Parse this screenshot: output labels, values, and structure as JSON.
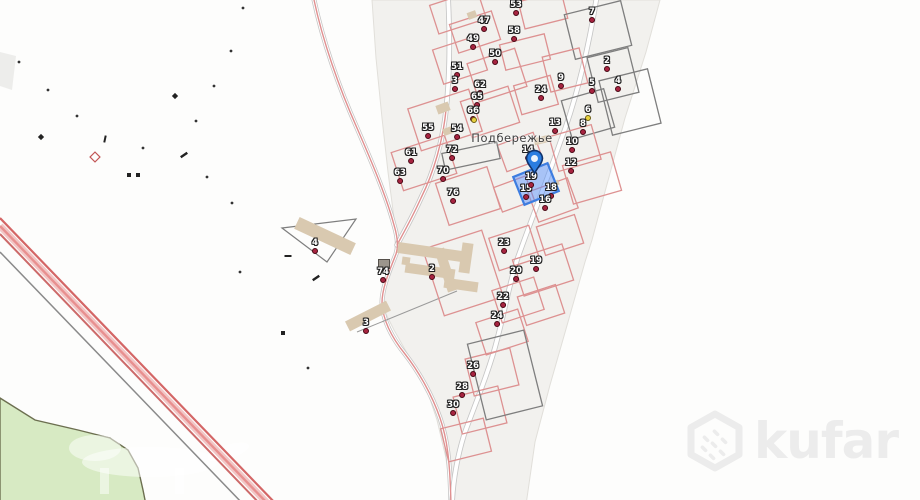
{
  "map": {
    "place_label": "Подбережье",
    "watermark_text": "kufar",
    "colors": {
      "background": "#fdfdfc",
      "residential_fill": "#f2f1ee",
      "residential_edge": "#e1dfda",
      "green_area": "#d7eac3",
      "green_edge": "#6c6f50",
      "road_casing": "#c6c6c6",
      "road_fill": "#ffffff",
      "route_pink": "#e09090",
      "railway_red": "#cc4b4b",
      "railway_light": "#f2c6c6",
      "parcel_red": "#dd9191",
      "parcel_dark": "#7e7e7e",
      "building_fill": "#d9c9b0",
      "marker_dot": "#a72440",
      "marker_yellow": "#e8d23f",
      "selected_fill": "rgba(77,140,255,0.45)",
      "selected_stroke": "#3d7de0",
      "pin_blue": "#2a7de1",
      "watermark_gray": "#ececec"
    },
    "selected_marker": {
      "n": "19",
      "x": 531,
      "y": 177
    },
    "pin": {
      "x": 534,
      "y": 174
    },
    "selected_parcel": {
      "x": 536,
      "y": 184,
      "w": 37,
      "h": 30,
      "r": -22
    },
    "markers": [
      {
        "n": "53",
        "x": 516,
        "y": 5
      },
      {
        "n": "7",
        "x": 592,
        "y": 12
      },
      {
        "n": "47",
        "x": 484,
        "y": 21
      },
      {
        "n": "58",
        "x": 514,
        "y": 31
      },
      {
        "n": "49",
        "x": 473,
        "y": 39
      },
      {
        "n": "50",
        "x": 495,
        "y": 54
      },
      {
        "n": "2",
        "x": 607,
        "y": 61
      },
      {
        "n": "51",
        "x": 457,
        "y": 67
      },
      {
        "n": "9",
        "x": 561,
        "y": 78
      },
      {
        "n": "3",
        "x": 455,
        "y": 81
      },
      {
        "n": "4",
        "x": 618,
        "y": 81
      },
      {
        "n": "5",
        "x": 592,
        "y": 83
      },
      {
        "n": "62",
        "x": 480,
        "y": 85
      },
      {
        "n": "24",
        "x": 541,
        "y": 90
      },
      {
        "n": "65",
        "x": 477,
        "y": 97
      },
      {
        "n": "6",
        "x": 588,
        "y": 110,
        "dot": "yellow"
      },
      {
        "n": "66",
        "x": 473,
        "y": 111
      },
      {
        "n": "13",
        "x": 555,
        "y": 123
      },
      {
        "n": "8",
        "x": 583,
        "y": 124
      },
      {
        "n": "55",
        "x": 428,
        "y": 128
      },
      {
        "n": "54",
        "x": 457,
        "y": 129
      },
      {
        "n": "10",
        "x": 572,
        "y": 142
      },
      {
        "n": "72",
        "x": 452,
        "y": 150
      },
      {
        "n": "14",
        "x": 528,
        "y": 150
      },
      {
        "n": "61",
        "x": 411,
        "y": 153
      },
      {
        "n": "12",
        "x": 571,
        "y": 163
      },
      {
        "n": "70",
        "x": 443,
        "y": 171
      },
      {
        "n": "63",
        "x": 400,
        "y": 173
      },
      {
        "n": "15",
        "x": 526,
        "y": 189
      },
      {
        "n": "18",
        "x": 551,
        "y": 188
      },
      {
        "n": "76",
        "x": 453,
        "y": 193
      },
      {
        "n": "16",
        "x": 545,
        "y": 200
      },
      {
        "n": "4",
        "x": 315,
        "y": 243
      },
      {
        "n": "23",
        "x": 504,
        "y": 243
      },
      {
        "n": "19",
        "x": 536,
        "y": 261
      },
      {
        "n": "2",
        "x": 432,
        "y": 269
      },
      {
        "n": "20",
        "x": 516,
        "y": 271
      },
      {
        "n": "74",
        "x": 383,
        "y": 272
      },
      {
        "n": "22",
        "x": 503,
        "y": 297
      },
      {
        "n": "24",
        "x": 497,
        "y": 316
      },
      {
        "n": "3",
        "x": 366,
        "y": 323
      },
      {
        "n": "26",
        "x": 473,
        "y": 366
      },
      {
        "n": "28",
        "x": 462,
        "y": 387
      },
      {
        "n": "30",
        "x": 453,
        "y": 405
      }
    ],
    "extra_dots": [
      {
        "x": 474,
        "y": 119,
        "dot": "yellow"
      }
    ],
    "parcels": [
      [
        458,
        12,
        50,
        30,
        -18,
        "red"
      ],
      [
        475,
        32,
        44,
        30,
        -18,
        "red"
      ],
      [
        543,
        10,
        44,
        28,
        -14,
        "red"
      ],
      [
        598,
        30,
        58,
        46,
        -14,
        "dark"
      ],
      [
        525,
        52,
        46,
        26,
        -14,
        "red"
      ],
      [
        460,
        60,
        46,
        36,
        -18,
        "red"
      ],
      [
        497,
        75,
        50,
        40,
        -18,
        "red"
      ],
      [
        565,
        70,
        38,
        36,
        -14,
        "red"
      ],
      [
        613,
        75,
        42,
        46,
        -14,
        "dark"
      ],
      [
        445,
        120,
        64,
        44,
        -18,
        "red"
      ],
      [
        490,
        112,
        50,
        38,
        -18,
        "red"
      ],
      [
        588,
        114,
        44,
        40,
        -16,
        "dark"
      ],
      [
        630,
        102,
        50,
        56,
        -14,
        "dark"
      ],
      [
        424,
        163,
        56,
        40,
        -18,
        "red"
      ],
      [
        575,
        148,
        44,
        36,
        -16,
        "red"
      ],
      [
        592,
        178,
        50,
        40,
        -16,
        "red"
      ],
      [
        520,
        152,
        38,
        28,
        -20,
        "red"
      ],
      [
        468,
        196,
        54,
        44,
        -18,
        "red"
      ],
      [
        514,
        194,
        34,
        26,
        -20,
        "red"
      ],
      [
        553,
        200,
        42,
        32,
        -20,
        "red"
      ],
      [
        560,
        235,
        40,
        30,
        -18,
        "red"
      ],
      [
        514,
        248,
        42,
        34,
        -18,
        "red"
      ],
      [
        543,
        270,
        52,
        38,
        -18,
        "red"
      ],
      [
        541,
        305,
        40,
        30,
        -18,
        "red"
      ],
      [
        518,
        300,
        44,
        34,
        -18,
        "red"
      ],
      [
        502,
        332,
        44,
        34,
        -18,
        "red"
      ],
      [
        492,
        372,
        46,
        38,
        -14,
        "red"
      ],
      [
        480,
        410,
        46,
        38,
        -14,
        "red"
      ],
      [
        466,
        440,
        44,
        34,
        -14,
        "red"
      ],
      [
        505,
        375,
        58,
        78,
        -14,
        "dark"
      ],
      [
        463,
        273,
        62,
        70,
        -18,
        "red"
      ],
      [
        471,
        156,
        56,
        17,
        -12,
        "dark"
      ],
      [
        536,
        95,
        38,
        30,
        -16,
        "red"
      ]
    ],
    "buildings": [
      [
        325,
        236,
        62,
        13,
        25
      ],
      [
        430,
        252,
        65,
        11,
        8
      ],
      [
        466,
        258,
        11,
        30,
        8
      ],
      [
        430,
        271,
        50,
        10,
        8
      ],
      [
        461,
        285,
        34,
        10,
        8
      ],
      [
        406,
        261,
        8,
        8,
        8
      ],
      [
        368,
        316,
        46,
        11,
        -27
      ],
      [
        443,
        108,
        13,
        9,
        -20
      ],
      [
        542,
        140,
        16,
        7,
        -14
      ],
      [
        472,
        15,
        9,
        7,
        -20
      ],
      [
        448,
        131,
        10,
        7,
        -20
      ],
      [
        556,
        183,
        6,
        5,
        -20
      ],
      [
        446,
        270,
        10,
        44,
        -18
      ]
    ],
    "dark_building": [
      384,
      264,
      11,
      9
    ],
    "triangle_parcel": "282,228 356,219 327,262",
    "scatter": [
      {
        "x": 243,
        "y": 8,
        "t": "dot"
      },
      {
        "x": 231,
        "y": 51,
        "t": "dot"
      },
      {
        "x": 19,
        "y": 62,
        "t": "dot"
      },
      {
        "x": 48,
        "y": 90,
        "t": "dot"
      },
      {
        "x": 214,
        "y": 86,
        "t": "dot"
      },
      {
        "x": 175,
        "y": 96,
        "t": "star"
      },
      {
        "x": 77,
        "y": 116,
        "t": "dot"
      },
      {
        "x": 196,
        "y": 121,
        "t": "dot"
      },
      {
        "x": 41,
        "y": 137,
        "t": "star"
      },
      {
        "x": 105,
        "y": 139,
        "t": "vdash"
      },
      {
        "x": 143,
        "y": 148,
        "t": "dot"
      },
      {
        "x": 184,
        "y": 155,
        "t": "ddash"
      },
      {
        "x": 95,
        "y": 157,
        "t": "diamond"
      },
      {
        "x": 129,
        "y": 175,
        "t": "sq"
      },
      {
        "x": 138,
        "y": 175,
        "t": "sq"
      },
      {
        "x": 207,
        "y": 177,
        "t": "dot"
      },
      {
        "x": 232,
        "y": 203,
        "t": "dot"
      },
      {
        "x": 288,
        "y": 256,
        "t": "hdash"
      },
      {
        "x": 240,
        "y": 272,
        "t": "dot"
      },
      {
        "x": 316,
        "y": 278,
        "t": "ddash"
      },
      {
        "x": 283,
        "y": 333,
        "t": "sq"
      },
      {
        "x": 308,
        "y": 368,
        "t": "dot"
      }
    ],
    "roads": {
      "main_street": "M 597,-5 C 590,40 578,95 561,140 C 547,180 533,215 517,260 C 509,285 505,310 497,340 C 489,372 472,412 464,435 C 457,458 453,480 452,505",
      "west_street": "M 448,-5 C 450,35 450,75 446,110 C 443,140 434,172 421,198 C 412,218 404,232 397,245",
      "curving_road": "M 313,-5 C 322,40 340,90 357,128 C 370,158 386,195 394,225 C 398,238 398,248 396,254 C 389,272 382,288 382,303 C 383,320 392,338 405,354 C 419,372 432,395 440,418 C 447,438 450,460 451,505",
      "route_overlay": "M 446,110 C 443,140 434,172 421,198 C 412,218 404,232 397,245",
      "railway_gray": "M 0,252 L 244,505",
      "railway_band": [
        "M 0,218 L 277,505",
        "M 0,226 L 269,505",
        "M 0,234 L 261,505"
      ]
    },
    "residential_polygon": "372,0 660,0 646,52 625,118 606,188 592,240 585,262 568,322 550,385 535,442 526,505 452,505 446,458 437,420 423,378 407,353 394,330 384,310 384,288 397,250 399,240 394,218 388,172 382,118 376,58",
    "green_polygon": "0,398 35,420 78,430 110,438 128,450 138,468 143,490 146,505 0,505",
    "gray_sliver": "0,52 16,56 12,90 0,86"
  }
}
